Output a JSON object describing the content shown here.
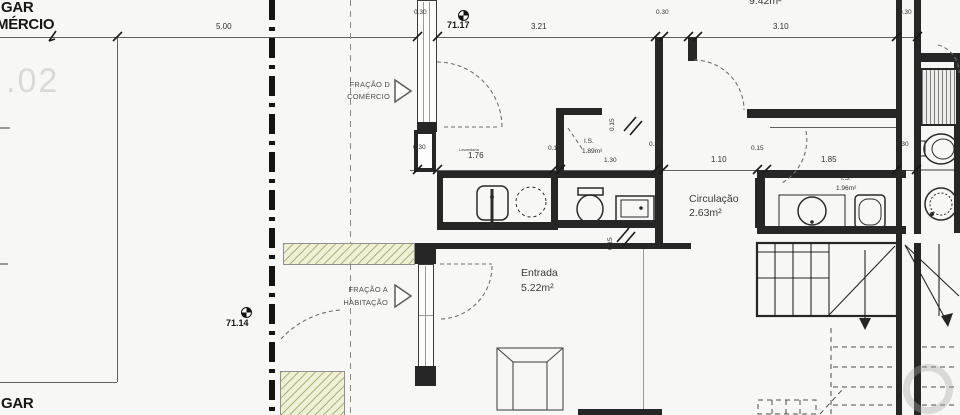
{
  "summary": {
    "drawing_type": "architectural floor plan — ground floor entrance detail",
    "language": "Portuguese",
    "rooms": [
      {
        "name": "Entrada",
        "area_m2": "5.22"
      },
      {
        "name": "Circulação",
        "area_m2": "2.63"
      },
      {
        "name": "I.S.",
        "area_m2": "1.89"
      },
      {
        "name": "I.S.",
        "area_m2": "1.96"
      },
      {
        "name": "",
        "area_m2": "9.42"
      }
    ],
    "levels": [
      "71.17",
      "71.14"
    ],
    "fractions": [
      "FRAÇÃO D — COMÉRCIO",
      "FRAÇÃO A — HABITAÇÃO"
    ]
  },
  "colors": {
    "paper": "#f7f7f5",
    "line": "#2a2a2a",
    "hatch_fill": "#eff1d6",
    "hatch_line": "#8c9150",
    "ghost_text": "#d9d9d9"
  },
  "icons": [
    {
      "name": "benchmark-level-icon",
      "meaning": "survey level marker (quartered circle)"
    },
    {
      "name": "fraction-arrow-icon",
      "meaning": "open triangle pointing to fraction entrance"
    },
    {
      "name": "stair-direction-arrow-icon",
      "meaning": "stair walk-line arrowhead"
    }
  ],
  "annotations": [
    {
      "n": "label-gar-top",
      "t": "GAR",
      "x": 1,
      "y": 0,
      "c": "big"
    },
    {
      "n": "label-mercio",
      "t": "MÉRCIO",
      "x": -4,
      "y": 17,
      "c": "big"
    },
    {
      "n": "label-ghost-02",
      "t": ".02",
      "x": 6,
      "y": 64,
      "c": "ghost"
    },
    {
      "n": "label-gar-bottom",
      "t": "GAR",
      "x": 1,
      "y": 396,
      "c": "big"
    },
    {
      "n": "dim-5-00",
      "t": "5.00",
      "x": 216,
      "y": 23,
      "c": "dim"
    },
    {
      "n": "level-71-17",
      "t": "71.17",
      "x": 447,
      "y": 21,
      "c": "dimb"
    },
    {
      "n": "dim-3-21",
      "t": "3.21",
      "x": 531,
      "y": 23,
      "c": "dim"
    },
    {
      "n": "dim-3-10",
      "t": "3.10",
      "x": 773,
      "y": 23,
      "c": "dim"
    },
    {
      "n": "room-area-9-42",
      "t": "9.42m²",
      "x": 749,
      "y": -4,
      "c": "room"
    },
    {
      "n": "dim-0-30-top-left",
      "t": "0.30",
      "x": 414,
      "y": 10,
      "c": "dims"
    },
    {
      "n": "dim-0-30-top-mid",
      "t": "0.30",
      "x": 656,
      "y": 10,
      "c": "dims"
    },
    {
      "n": "dim-0-30-top-right",
      "t": "0.30",
      "x": 899,
      "y": 10,
      "c": "dims"
    },
    {
      "n": "dim-0-30-mid-left",
      "t": "0.30",
      "x": 413,
      "y": 145,
      "c": "dims"
    },
    {
      "n": "dim-0-30-mid-center",
      "t": "0.30",
      "x": 649,
      "y": 142,
      "c": "dims"
    },
    {
      "n": "dim-0-30-mid-right",
      "t": "0.30",
      "x": 896,
      "y": 142,
      "c": "dims"
    },
    {
      "n": "label-lavandaria",
      "t": "Lavandaria",
      "x": 459,
      "y": 148,
      "c": "tiny"
    },
    {
      "n": "dim-1-76",
      "t": "1.76",
      "x": 468,
      "y": 152,
      "c": "dim"
    },
    {
      "n": "dim-0-15-a",
      "t": "0.15",
      "x": 548,
      "y": 146,
      "c": "dims"
    },
    {
      "n": "room-is-189-line1",
      "t": "I.S.",
      "x": 584,
      "y": 139,
      "c": "dims"
    },
    {
      "n": "room-is-189-line2",
      "t": "1.89m²",
      "x": 582,
      "y": 149,
      "c": "dims"
    },
    {
      "n": "dim-1-30",
      "t": "1.30",
      "x": 604,
      "y": 158,
      "c": "dims"
    },
    {
      "n": "dim-0-15-v1",
      "t": "0.15",
      "x": 610,
      "y": 131,
      "c": "dims",
      "r": -90
    },
    {
      "n": "dim-0-15-v2",
      "t": "0.15",
      "x": 608,
      "y": 250,
      "c": "dims",
      "r": -90
    },
    {
      "n": "dim-1-10",
      "t": "1.10",
      "x": 711,
      "y": 156,
      "c": "dim"
    },
    {
      "n": "dim-0-15-b",
      "t": "0.15",
      "x": 751,
      "y": 146,
      "c": "dims"
    },
    {
      "n": "dim-1-85",
      "t": "1.85",
      "x": 821,
      "y": 156,
      "c": "dim"
    },
    {
      "n": "room-circulacao-line1",
      "t": "Circulação",
      "x": 689,
      "y": 194,
      "c": "room"
    },
    {
      "n": "room-circulacao-line2",
      "t": "2.63m²",
      "x": 689,
      "y": 208,
      "c": "room"
    },
    {
      "n": "room-is-196-line1",
      "t": "I.S.",
      "x": 841,
      "y": 176,
      "c": "dims"
    },
    {
      "n": "room-is-196-line2",
      "t": "1.96m²",
      "x": 836,
      "y": 186,
      "c": "dims"
    },
    {
      "n": "room-entrada-line1",
      "t": "Entrada",
      "x": 521,
      "y": 268,
      "c": "room"
    },
    {
      "n": "room-entrada-line2",
      "t": "5.22m²",
      "x": 521,
      "y": 283,
      "c": "room"
    },
    {
      "n": "label-fracao-d-line1",
      "t": "FRAÇÃO D",
      "x": 328,
      "y": 81,
      "c": "frac"
    },
    {
      "n": "label-fracao-d-line2",
      "t": "COMÉRCIO",
      "x": 328,
      "y": 93,
      "c": "frac"
    },
    {
      "n": "label-fracao-a-line1",
      "t": "FRAÇÃO A",
      "x": 326,
      "y": 286,
      "c": "frac"
    },
    {
      "n": "label-fracao-a-line2",
      "t": "HABITAÇÃO",
      "x": 326,
      "y": 299,
      "c": "frac"
    },
    {
      "n": "level-71-14",
      "t": "71.14",
      "x": 226,
      "y": 319,
      "c": "dimb"
    }
  ]
}
